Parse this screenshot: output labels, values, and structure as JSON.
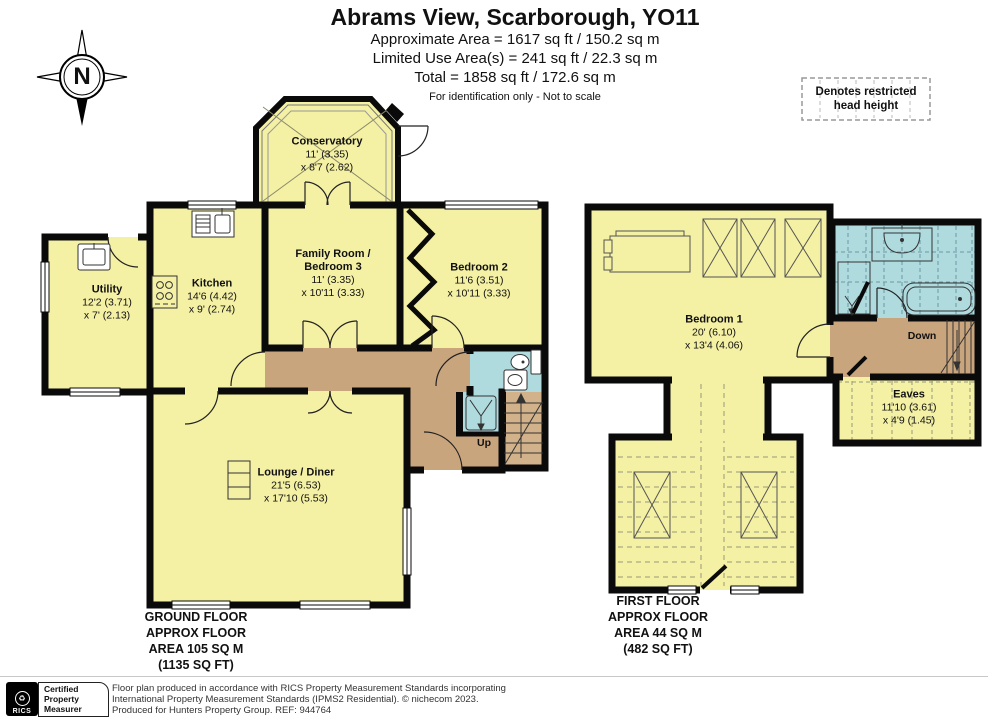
{
  "header": {
    "title": "Abrams View, Scarborough, YO11",
    "area_line1": "Approximate Area = 1617 sq ft / 150.2 sq m",
    "area_line2": "Limited Use Area(s) = 241 sq ft / 22.3 sq m",
    "area_line3": "Total = 1858 sq ft / 172.6 sq m",
    "note": "For identification only - Not to scale"
  },
  "legend": {
    "line1": "Denotes restricted",
    "line2": "head height"
  },
  "compass": {
    "label": "N"
  },
  "ground_floor": {
    "rooms": {
      "conservatory": {
        "name": "Conservatory",
        "dim1": "11' (3.35)",
        "dim2": "x 8'7 (2.62)"
      },
      "utility": {
        "name": "Utility",
        "dim1": "12'2 (3.71)",
        "dim2": "x 7' (2.13)"
      },
      "kitchen": {
        "name": "Kitchen",
        "dim1": "14'6 (4.42)",
        "dim2": "x 9' (2.74)"
      },
      "family_room": {
        "name": "Family Room /",
        "name2": "Bedroom 3",
        "dim1": "11' (3.35)",
        "dim2": "x 10'11 (3.33)"
      },
      "bedroom2": {
        "name": "Bedroom 2",
        "dim1": "11'6 (3.51)",
        "dim2": "x 10'11 (3.33)"
      },
      "lounge": {
        "name": "Lounge / Diner",
        "dim1": "21'5 (6.53)",
        "dim2": "x 17'10 (5.53)"
      }
    },
    "stairs_label": "Up",
    "caption": [
      "GROUND FLOOR",
      "APPROX FLOOR",
      "AREA 105 SQ M",
      "(1135 SQ FT)"
    ]
  },
  "first_floor": {
    "rooms": {
      "bedroom1": {
        "name": "Bedroom 1",
        "dim1": "20' (6.10)",
        "dim2": "x 13'4 (4.06)"
      },
      "eaves": {
        "name": "Eaves",
        "dim1": "11'10 (3.61)",
        "dim2": "x 4'9 (1.45)"
      }
    },
    "stairs_label": "Down",
    "caption": [
      "FIRST FLOOR",
      "APPROX FLOOR",
      "AREA 44 SQ M",
      "(482 SQ FT)"
    ]
  },
  "footer": {
    "rics_logo": "RICS",
    "badge_line1": "Certified",
    "badge_line2": "Property",
    "badge_line3": "Measurer",
    "disclaimer_line1": "Floor plan produced in accordance with RICS Property Measurement Standards incorporating",
    "disclaimer_line2": "International Property Measurement Standards (IPMS2 Residential).  © nichecom 2023.",
    "disclaimer_line3": "Produced for Hunters Property Group. REF: 944764"
  },
  "colors": {
    "room": "#F4F0A4",
    "hall": "#C9A57E",
    "bath": "#AFDBDF",
    "wall": "#0a0a0a"
  }
}
